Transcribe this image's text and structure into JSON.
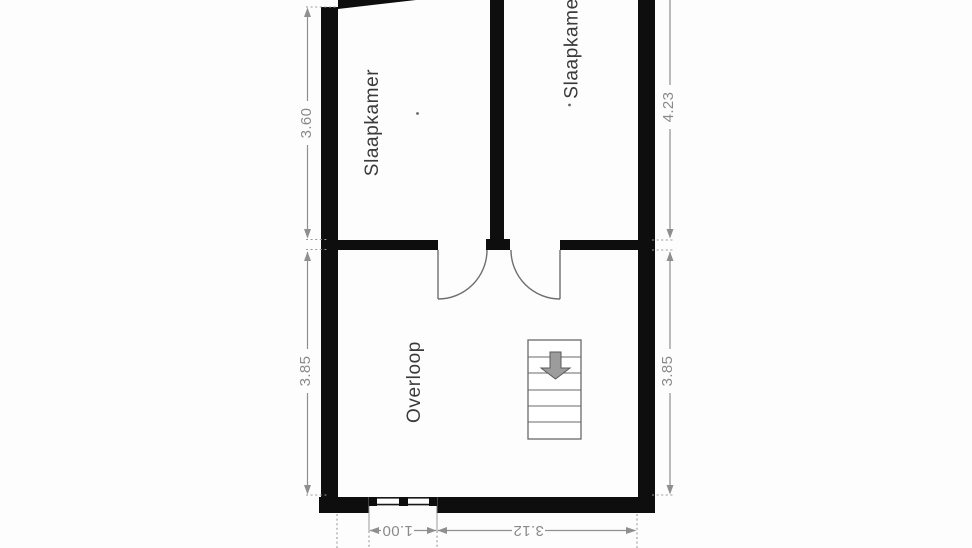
{
  "rooms": [
    {
      "name": "slaapkamer-left",
      "label": "Slaapkamer"
    },
    {
      "name": "slaapkamer-right",
      "label": "Slaapkamer"
    },
    {
      "name": "overloop",
      "label": "Overloop"
    }
  ],
  "dimensions": {
    "left_top": "3.60",
    "left_bottom": "3.85",
    "right_top": "4.23",
    "right_bottom": "3.85",
    "bottom_window": "1.00",
    "bottom_right": "3.12"
  },
  "stairs": {
    "treads": 6,
    "direction_icon": "arrow-down"
  },
  "colors": {
    "wall": "#0e0e0e",
    "dimension": "#8a8a8a",
    "room_label": "#3b3b3b",
    "stair_arrow": "#9c9c9c"
  }
}
